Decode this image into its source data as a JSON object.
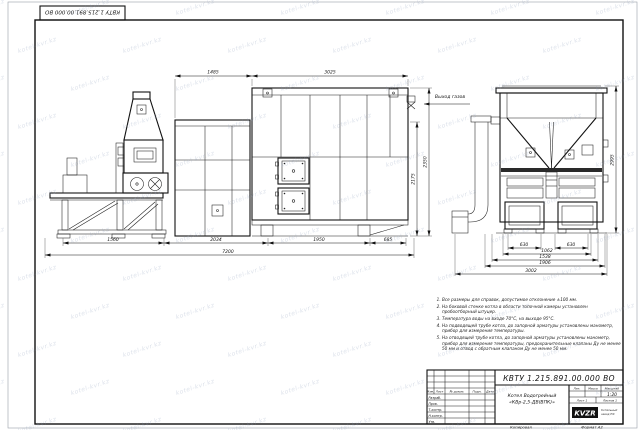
{
  "sheet": {
    "stamp_rotated": "КВТУ 1.215.891.00.000 ВО",
    "copied_label": "Копировал",
    "format_label": "Формат А2"
  },
  "watermark": {
    "text": "kotel-kvr.kz"
  },
  "front_view": {
    "gas_outlet_label": "Выход газов",
    "top_dims": [
      "1485",
      "3025"
    ],
    "bottom_dims": [
      "1560",
      "2034",
      "1950",
      "685"
    ],
    "overall_dim": "7200",
    "height_dims": [
      "2175",
      "2350"
    ]
  },
  "side_view": {
    "bottom_dims": [
      "630",
      "630",
      "1062",
      "1538",
      "1906",
      "3002"
    ],
    "height_dim": "2995"
  },
  "notes": {
    "items": [
      "Все размеры для справок, допустимое отклонение ±100 мм.",
      "На боковой стенке котла в области топочной камеры установлен пробоотборный штуцер.",
      "Температура воды на входе 70°С, на выходе 95°С.",
      "На подводящей трубе котла, до запорной арматуры установлены манометр, прибор для измерения температуры.",
      "На отводящей трубе котла, до запорной арматуры установлены манометр, прибор для измерения температуры, предохранительные клапаны Ду не менее 50 мм и отвод с обратным клапаном Ду не менее 50 мм."
    ]
  },
  "title_block": {
    "doc_number": "КВТУ 1.215.891.00.000 ВО",
    "name_line1": "Котел Водогрейный",
    "name_line2": "«КВр-2,5-ДВ(ВПК)»",
    "col_izm": "Изм.",
    "col_list": "Лист",
    "col_doc": "№ докум.",
    "col_podp": "Подп.",
    "col_data": "Дата",
    "row_razrab": "Разраб.",
    "row_prov": "Пров.",
    "row_tkontr": "Т.контр.",
    "row_nkontr": "Н.контр.",
    "row_utv": "Утв.",
    "lit_label": "Лит.",
    "mass_label": "Масса",
    "scale_label": "Масштаб",
    "scale_value": "1:20",
    "sheet_label": "Лист 1",
    "sheets_label": "Листов 1",
    "logo_text": "KVZR",
    "logo_caption1": "Котельный",
    "logo_caption2": "завод РФ"
  }
}
